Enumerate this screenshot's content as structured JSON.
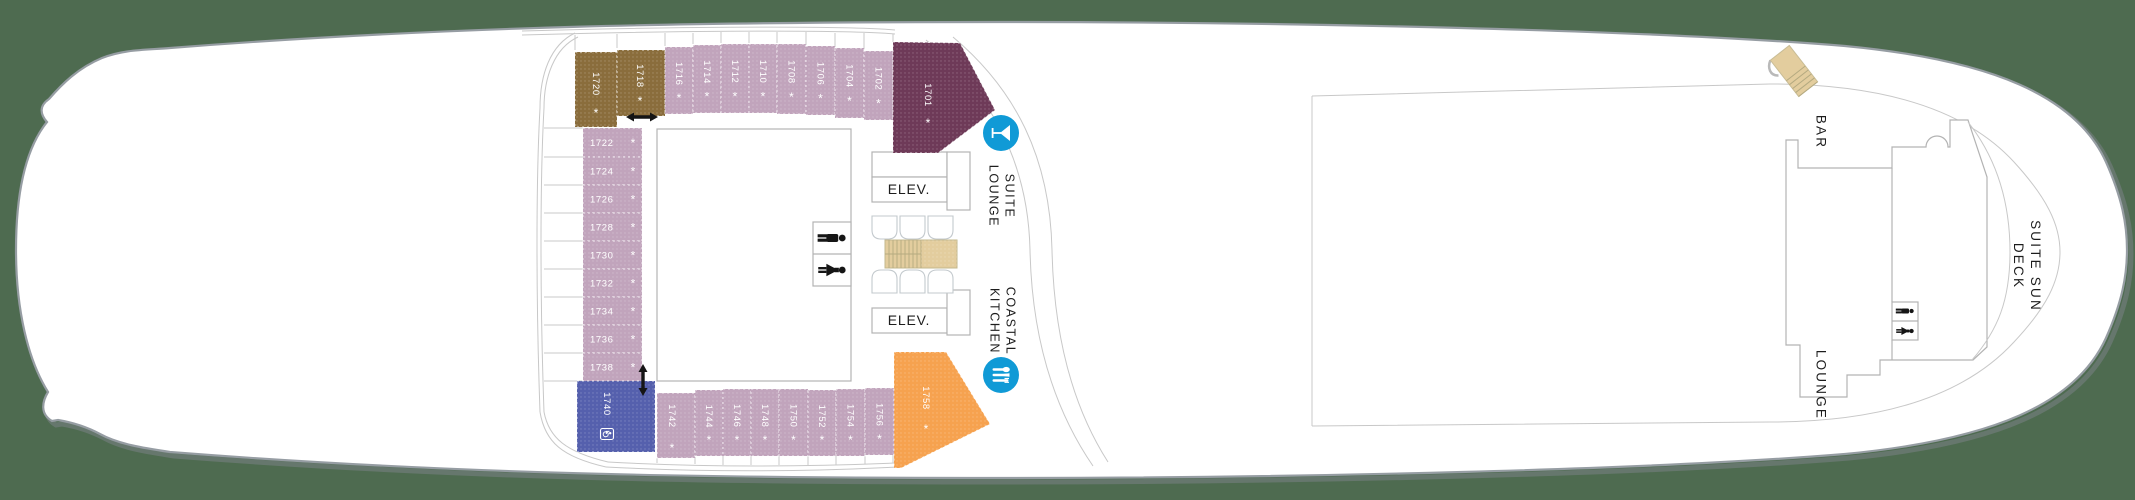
{
  "deck_plan": {
    "labels": {
      "elevator_top": "ELEV.",
      "elevator_bottom": "ELEV.",
      "suite_lounge": "SUITE\nLOUNGE",
      "coastal_kitchen": "COASTAL\nKITCHEN",
      "bar": "BAR",
      "lounge": "LOUNGE",
      "suite_sun_deck": "SUITE SUN DECK"
    },
    "symbols": {
      "asterisk": "*"
    },
    "colors": {
      "background": "#4e6b50",
      "hull_fill": "#ffffff",
      "cabin_mauve": "#c1a4bc",
      "cabin_brown": "#8a6d3c",
      "cabin_maroon": "#6e3a58",
      "cabin_orange": "#f6a24f",
      "cabin_indigo": "#5560ad",
      "icon_blue": "#109ad6",
      "stairs_tan": "#e3cd9e",
      "icon_black": "#151515",
      "cabin_text": "#ffffff"
    },
    "cabins": [
      {
        "number": "1720",
        "color_key": "cabin_brown",
        "rect": [
          575,
          52,
          42,
          75
        ],
        "orient": "v",
        "symbol": "asterisk",
        "tx": 596,
        "ty": 84,
        "ax": 596,
        "ay": 113
      },
      {
        "number": "1718",
        "color_key": "cabin_brown",
        "rect": [
          617,
          50,
          48,
          66
        ],
        "orient": "v",
        "symbol": "asterisk",
        "tx": 640,
        "ty": 76,
        "ax": 640,
        "ay": 101
      },
      {
        "number": "1716",
        "color_key": "cabin_mauve",
        "rect": [
          665,
          47,
          28,
          67
        ],
        "orient": "v",
        "symbol": "asterisk"
      },
      {
        "number": "1714",
        "color_key": "cabin_mauve",
        "rect": [
          693,
          45,
          28,
          68
        ],
        "orient": "v",
        "symbol": "asterisk"
      },
      {
        "number": "1712",
        "color_key": "cabin_mauve",
        "rect": [
          721,
          44,
          28,
          69
        ],
        "orient": "v",
        "symbol": "asterisk"
      },
      {
        "number": "1710",
        "color_key": "cabin_mauve",
        "rect": [
          749,
          44,
          28,
          69
        ],
        "orient": "v",
        "symbol": "asterisk"
      },
      {
        "number": "1708",
        "color_key": "cabin_mauve",
        "rect": [
          777,
          44,
          29,
          70
        ],
        "orient": "v",
        "symbol": "asterisk"
      },
      {
        "number": "1706",
        "color_key": "cabin_mauve",
        "rect": [
          806,
          46,
          29,
          69
        ],
        "orient": "v",
        "symbol": "asterisk"
      },
      {
        "number": "1704",
        "color_key": "cabin_mauve",
        "rect": [
          835,
          48,
          29,
          70
        ],
        "orient": "v",
        "symbol": "asterisk"
      },
      {
        "number": "1702",
        "color_key": "cabin_mauve",
        "rect": [
          864,
          51,
          29,
          69
        ],
        "orient": "v",
        "symbol": "asterisk"
      },
      {
        "number": "1701",
        "color_key": "cabin_maroon",
        "poly": [
          [
            893,
            42
          ],
          [
            960,
            43
          ],
          [
            995,
            110
          ],
          [
            938,
            153
          ],
          [
            893,
            153
          ]
        ],
        "orient": "v",
        "symbol": "asterisk",
        "tx": 928,
        "ty": 95,
        "ax": 928,
        "ay": 123
      },
      {
        "number": "1722",
        "color_key": "cabin_mauve",
        "rect": [
          583,
          128,
          59,
          29
        ],
        "orient": "h",
        "symbol": "asterisk"
      },
      {
        "number": "1724",
        "color_key": "cabin_mauve",
        "rect": [
          583,
          157,
          59,
          28
        ],
        "orient": "h",
        "symbol": "asterisk"
      },
      {
        "number": "1726",
        "color_key": "cabin_mauve",
        "rect": [
          583,
          185,
          59,
          28
        ],
        "orient": "h",
        "symbol": "asterisk"
      },
      {
        "number": "1728",
        "color_key": "cabin_mauve",
        "rect": [
          583,
          213,
          59,
          28
        ],
        "orient": "h",
        "symbol": "asterisk"
      },
      {
        "number": "1730",
        "color_key": "cabin_mauve",
        "rect": [
          583,
          241,
          59,
          28
        ],
        "orient": "h",
        "symbol": "asterisk"
      },
      {
        "number": "1732",
        "color_key": "cabin_mauve",
        "rect": [
          583,
          269,
          59,
          28
        ],
        "orient": "h",
        "symbol": "asterisk"
      },
      {
        "number": "1734",
        "color_key": "cabin_mauve",
        "rect": [
          583,
          297,
          59,
          28
        ],
        "orient": "h",
        "symbol": "asterisk"
      },
      {
        "number": "1736",
        "color_key": "cabin_mauve",
        "rect": [
          583,
          325,
          59,
          28
        ],
        "orient": "h",
        "symbol": "asterisk"
      },
      {
        "number": "1738",
        "color_key": "cabin_mauve",
        "rect": [
          583,
          353,
          59,
          28
        ],
        "orient": "h",
        "symbol": "asterisk"
      },
      {
        "number": "1740",
        "color_key": "cabin_indigo",
        "rect": [
          577,
          381,
          78,
          71
        ],
        "orient": "v",
        "symbol": "accessible",
        "tx": 607,
        "ty": 404,
        "ax": 607,
        "ay": 434
      },
      {
        "number": "1742",
        "color_key": "cabin_mauve",
        "rect": [
          657,
          393,
          38,
          65
        ],
        "orient": "v",
        "symbol": "asterisk",
        "tx": 672,
        "ty": 416,
        "ax": 672,
        "ay": 448
      },
      {
        "number": "1744",
        "color_key": "cabin_mauve",
        "rect": [
          695,
          390,
          28,
          66
        ],
        "orient": "v",
        "symbol": "asterisk"
      },
      {
        "number": "1746",
        "color_key": "cabin_mauve",
        "rect": [
          723,
          389,
          28,
          67
        ],
        "orient": "v",
        "symbol": "asterisk"
      },
      {
        "number": "1748",
        "color_key": "cabin_mauve",
        "rect": [
          751,
          389,
          28,
          67
        ],
        "orient": "v",
        "symbol": "asterisk"
      },
      {
        "number": "1750",
        "color_key": "cabin_mauve",
        "rect": [
          779,
          389,
          29,
          67
        ],
        "orient": "v",
        "symbol": "asterisk"
      },
      {
        "number": "1752",
        "color_key": "cabin_mauve",
        "rect": [
          808,
          390,
          28,
          66
        ],
        "orient": "v",
        "symbol": "asterisk"
      },
      {
        "number": "1754",
        "color_key": "cabin_mauve",
        "rect": [
          836,
          389,
          29,
          67
        ],
        "orient": "v",
        "symbol": "asterisk"
      },
      {
        "number": "1756",
        "color_key": "cabin_mauve",
        "rect": [
          865,
          388,
          29,
          67
        ],
        "orient": "v",
        "symbol": "asterisk"
      },
      {
        "number": "1758",
        "color_key": "cabin_orange",
        "poly": [
          [
            894,
            352
          ],
          [
            946,
            352
          ],
          [
            990,
            424
          ],
          [
            901,
            468
          ],
          [
            894,
            468
          ]
        ],
        "orient": "v",
        "symbol": "asterisk",
        "tx": 926,
        "ty": 398,
        "ax": 926,
        "ay": 429
      }
    ],
    "icons": [
      {
        "name": "martini-bar-icon",
        "kind": "martini",
        "cx": 1001,
        "cy": 133
      },
      {
        "name": "dining-icon",
        "kind": "dining",
        "cx": 1001,
        "cy": 375
      },
      {
        "name": "restroom-male-icon",
        "kind": "male",
        "cx": 832,
        "cy": 238,
        "s": 1.25
      },
      {
        "name": "restroom-female-icon",
        "kind": "female",
        "cx": 832,
        "cy": 270,
        "s": 1.25
      },
      {
        "name": "restroom-male-icon",
        "kind": "male",
        "cx": 1905,
        "cy": 311,
        "s": 0.8
      },
      {
        "name": "restroom-female-icon",
        "kind": "female",
        "cx": 1905,
        "cy": 331,
        "s": 0.8
      },
      {
        "name": "connecting-rooms-arrow-icon",
        "kind": "arrow-h",
        "cx": 642,
        "cy": 117
      },
      {
        "name": "connecting-rooms-arrow-icon",
        "kind": "arrow-v",
        "cx": 643,
        "cy": 380
      },
      {
        "name": "stairs-icon",
        "kind": "stairs-mid",
        "x": 885,
        "y": 240,
        "w": 72,
        "h": 28
      },
      {
        "name": "stairs-icon",
        "kind": "stairs-bow",
        "cx": 1794,
        "cy": 71,
        "rot": -38
      }
    ]
  }
}
